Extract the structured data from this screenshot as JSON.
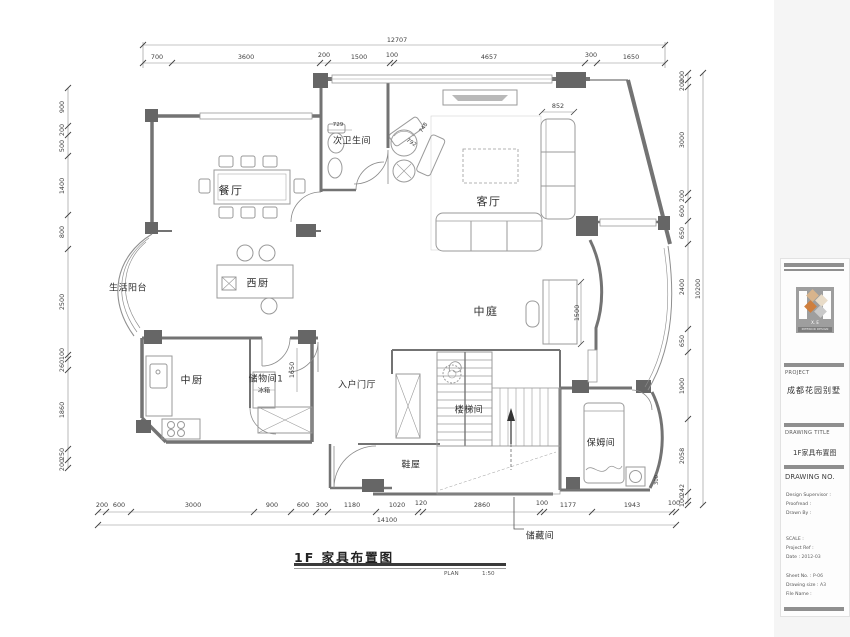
{
  "sheet": {
    "plan_title": "1F 家具布置图",
    "plan_label": "PLAN",
    "plan_scale": "1:50"
  },
  "rooms": {
    "dining": "餐厅",
    "second_bath": "次卫生间",
    "living": "客厅",
    "west_kitchen": "西厨",
    "life_balcony": "生活阳台",
    "atrium": "中庭",
    "chinese_kitchen": "中厨",
    "storage1": "储物间1",
    "entry_foyer": "入户门厅",
    "stairwell": "楼梯间",
    "shoe_room": "鞋屋",
    "nanny_room": "保姆间",
    "storage_cellar": "储藏间",
    "fridge": "冰箱"
  },
  "dims": {
    "top_total": "12707",
    "top": [
      "700",
      "3600",
      "200",
      "1500",
      "100",
      "4657",
      "300",
      "1650"
    ],
    "left": [
      "900",
      "200",
      "500",
      "1400",
      "800",
      "2500",
      "100",
      "260",
      "1860",
      "250",
      "200"
    ],
    "right": [
      "200",
      "200",
      "3000",
      "200",
      "600",
      "650",
      "2400",
      "650",
      "1900",
      "2058",
      "242",
      "100"
    ],
    "right_total": "10200",
    "bottom": [
      "200",
      "600",
      "3000",
      "900",
      "600",
      "300",
      "1180",
      "1020",
      "120",
      "2860",
      "100",
      "1177",
      "1943",
      "100"
    ],
    "bottom_total": "14100",
    "inner": {
      "toilet": "729",
      "chaise_w": "748",
      "chaise_d": "792",
      "sofa_w": "852",
      "piano_len": "1500",
      "storage_door": "1650",
      "nanny_step": "300"
    }
  },
  "titleblock": {
    "logo_name": "X. E",
    "logo_sub": "INTERIOR DESIGN",
    "project_label": "PROJECT",
    "project_name": "成都花园别墅",
    "drawing_title_label": "DRAWING TITLE",
    "drawing_title": "1F家具布置图",
    "drawing_no_label": "DRAWING NO.",
    "sign_fields": [
      {
        "label": "Design Supervisor :",
        "value": ""
      },
      {
        "label": "Proofread :",
        "value": ""
      },
      {
        "label": "Drawn By :",
        "value": ""
      }
    ],
    "meta_fields": [
      {
        "label": "SCALE :",
        "value": ""
      },
      {
        "label": "Project Ref :",
        "value": ""
      },
      {
        "label": "Date :",
        "value": "2012-03"
      }
    ],
    "file_fields": [
      {
        "label": "Sheet No. :",
        "value": "P-06"
      },
      {
        "label": "Drawing size :",
        "value": "A3"
      },
      {
        "label": "File Name :",
        "value": ""
      }
    ]
  },
  "colors": {
    "wall": "#737373",
    "column": "#666666",
    "furniture_line": "#9a9a9a",
    "logo_tan": "#d8b48c",
    "logo_orange": "#cf7f3e",
    "logo_cream": "#e9dcc8",
    "logo_gray": "#c9c9c9"
  }
}
